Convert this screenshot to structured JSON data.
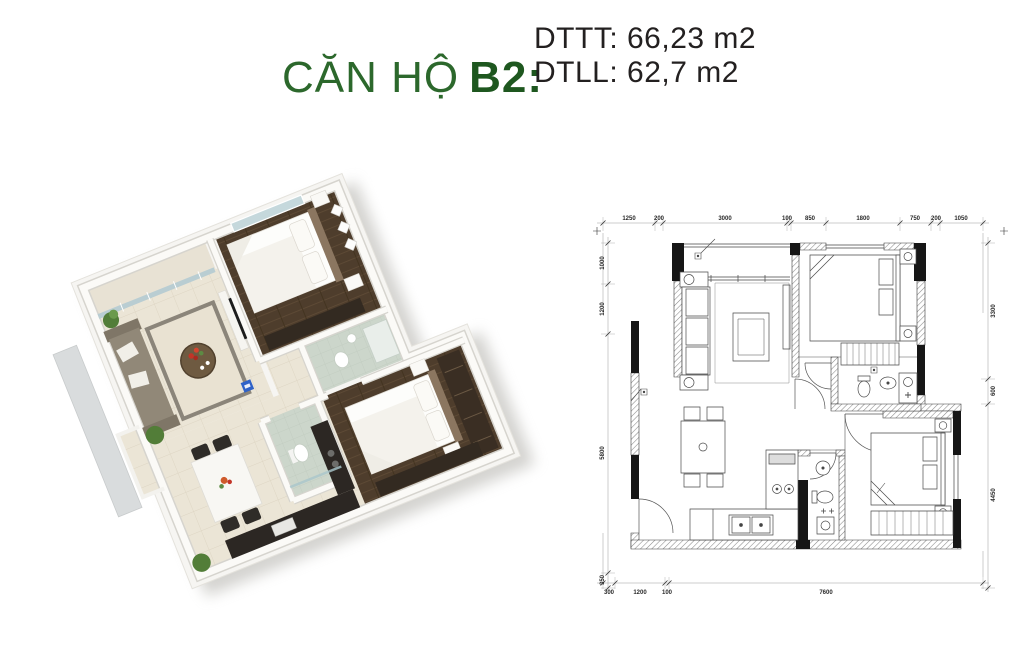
{
  "page": {
    "background_color": "#ffffff"
  },
  "header": {
    "title": "CĂN HỘ",
    "unit_code": "B2",
    "colon": ":",
    "title_color": "#2c682c",
    "areas": {
      "line1": "DTTT: 66,23 m2",
      "line2": "DTLL: 62,7 m2"
    }
  },
  "floor_plan_3d": {
    "rooms": [
      "balcony",
      "living-room",
      "bedroom-1",
      "bathroom-1",
      "bedroom-2",
      "bathroom-2",
      "dining-area",
      "kitchen",
      "entry"
    ],
    "palette": {
      "tile_floor": "#ebe5d6",
      "wood_floor": "#4e3d2c",
      "bath_tile": "#ccd6cb",
      "sofa": "#918878",
      "counter": "#2c2723",
      "accent_blue": "#2f62c8",
      "plant_green": "#5d8a43",
      "flower_red": "#c23527"
    }
  },
  "floor_plan_2d": {
    "dim_top": [
      "1250",
      "200",
      "3000",
      "100",
      "850",
      "1800",
      "750",
      "200",
      "1050"
    ],
    "dim_left": [
      "1000",
      "1200",
      "5800",
      "350"
    ],
    "dim_right": [
      "3300",
      "600",
      "4450"
    ],
    "dim_bottom": [
      "300",
      "1200",
      "100",
      "7600"
    ]
  }
}
